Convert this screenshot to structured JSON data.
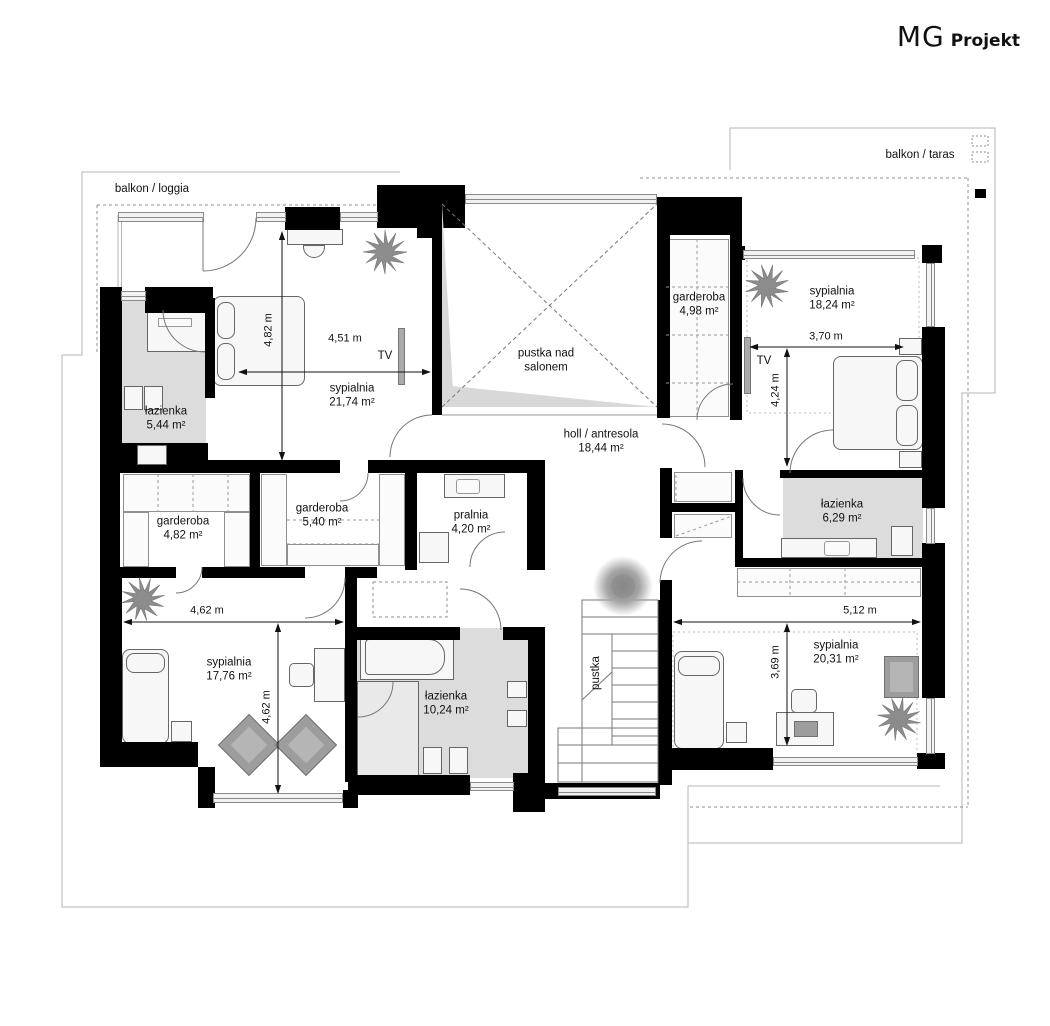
{
  "brand": {
    "name_primary": "MG",
    "name_secondary": "Projekt"
  },
  "outdoor": {
    "balcony_left": "balkon / loggia",
    "balcony_right": "balkon / taras"
  },
  "rooms": {
    "sypialnia1": {
      "name": "sypialnia",
      "area": "21,74 m²"
    },
    "lazienka1": {
      "name": "łazienka",
      "area": "5,44 m²"
    },
    "garderoba1": {
      "name": "garderoba",
      "area": "4,82 m²"
    },
    "garderoba2": {
      "name": "garderoba",
      "area": "5,40 m²"
    },
    "pralnia": {
      "name": "pralnia",
      "area": "4,20 m²"
    },
    "pustka_salon": {
      "line1": "pustka nad",
      "line2": "salonem"
    },
    "holl": {
      "name": "holl / antresola",
      "area": "18,44 m²"
    },
    "garderoba3": {
      "name": "garderoba",
      "area": "4,98 m²"
    },
    "sypialnia2": {
      "name": "sypialnia",
      "area": "18,24 m²"
    },
    "lazienka2": {
      "name": "łazienka",
      "area": "6,29 m²"
    },
    "sypialnia3": {
      "name": "sypialnia",
      "area": "17,76 m²"
    },
    "lazienka3": {
      "name": "łazienka",
      "area": "10,24 m²"
    },
    "sypialnia4": {
      "name": "sypialnia",
      "area": "20,31 m²"
    },
    "pustka_stairs": {
      "name": "pustka"
    }
  },
  "dimensions": {
    "bedroom1_width": "4,51 m",
    "bedroom1_height": "4,82 m",
    "bedroom2_width": "3,70 m",
    "bedroom2_height": "4,24 m",
    "bedroom3_width": "4,62 m",
    "bedroom3_height": "4,62 m",
    "bedroom4_width": "5,12 m",
    "bedroom4_height": "3,69 m"
  },
  "fixtures": {
    "tv1": "TV",
    "tv2": "TV"
  },
  "colors": {
    "wall": "#000000",
    "bathroom_fill": "#dcdcdc",
    "plant": "#8c8c8c",
    "window": "#8a8a8a"
  }
}
